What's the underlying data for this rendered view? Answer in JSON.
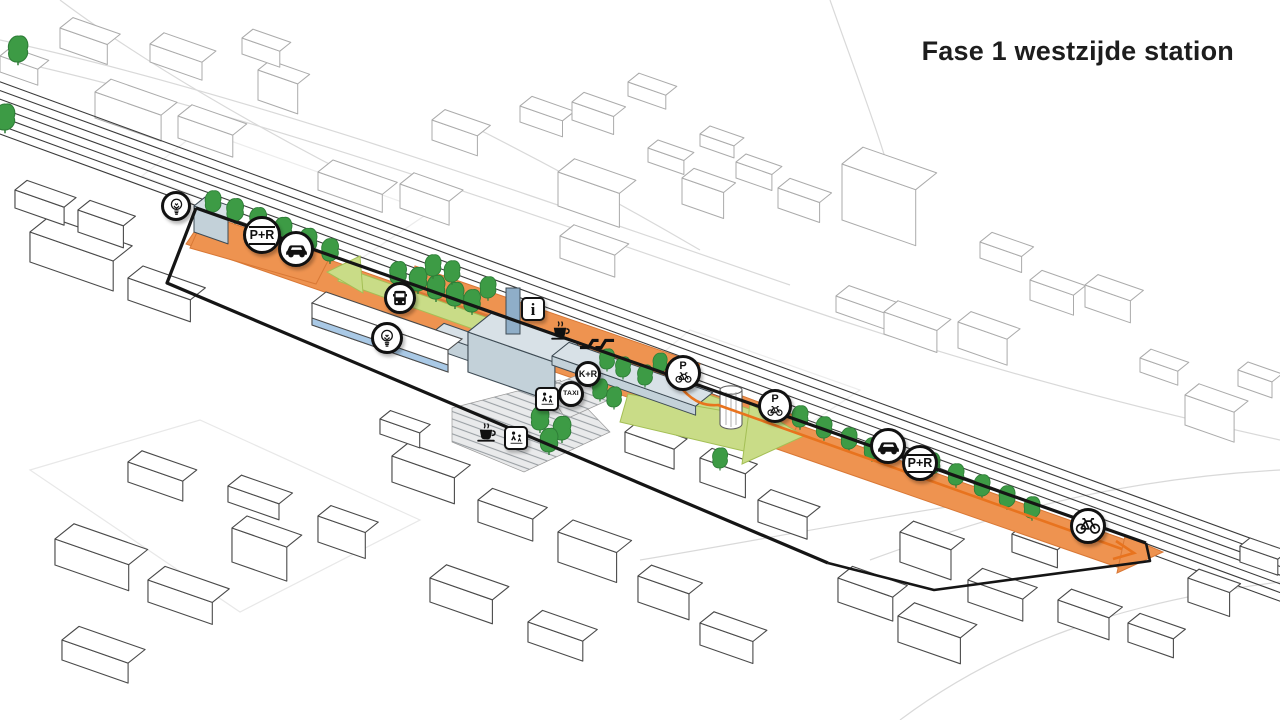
{
  "title": "Fase 1 westzijde station",
  "colors": {
    "promenade_orange": "#EE9350",
    "promenade_orange_dark": "#D97835",
    "arrow_orange": "#E8731E",
    "bike_lime": "#C9DC87",
    "bike_lime_dark": "#A4BF55",
    "tree_green": "#3D9B45",
    "tree_green_dark": "#2E7D37",
    "station_gray_top": "#D8E1E7",
    "station_gray_front": "#C3D1D9",
    "station_gray_side": "#CEDAE0",
    "station_stroke": "#3E4B54",
    "accent_blue": "#A9C9E6",
    "tower_blue": "#8FAEC8",
    "boundary_black": "#151515",
    "wire_bg": "#ABABAB",
    "wire_fg": "#4A4A4A",
    "rail_gray": "#3B3B3B",
    "road_gray": "#D9D9D9"
  },
  "badges": {
    "lightbulb_west": {
      "icon": "lightbulb-icon"
    },
    "park_ride_west": {
      "icon": "park-and-ride-icon",
      "label": "P+R"
    },
    "car_west": {
      "icon": "car-icon"
    },
    "bus": {
      "icon": "bus-icon"
    },
    "lightbulb_center": {
      "icon": "lightbulb-icon"
    },
    "info": {
      "icon": "info-icon",
      "label": "i"
    },
    "coffee_station": {
      "icon": "coffee-icon"
    },
    "ns_logo": {
      "icon": "ns-rail-logo-icon"
    },
    "kiss_ride": {
      "icon": "kiss-and-ride-icon",
      "label": "K+R"
    },
    "taxi": {
      "icon": "taxi-icon",
      "label": "TAXI"
    },
    "pedestrians_station": {
      "icon": "pedestrians-icon"
    },
    "bike_parking_station": {
      "icon": "bike-parking-icon",
      "label": "P"
    },
    "bike_parking_east": {
      "icon": "bike-parking-icon",
      "label": "P"
    },
    "car_east": {
      "icon": "car-icon"
    },
    "park_ride_east": {
      "icon": "park-and-ride-icon",
      "label": "P+R"
    },
    "coffee_plaza": {
      "icon": "coffee-icon"
    },
    "pedestrians_plaza": {
      "icon": "pedestrians-icon"
    },
    "bike_route_east": {
      "icon": "bicycle-icon"
    }
  }
}
